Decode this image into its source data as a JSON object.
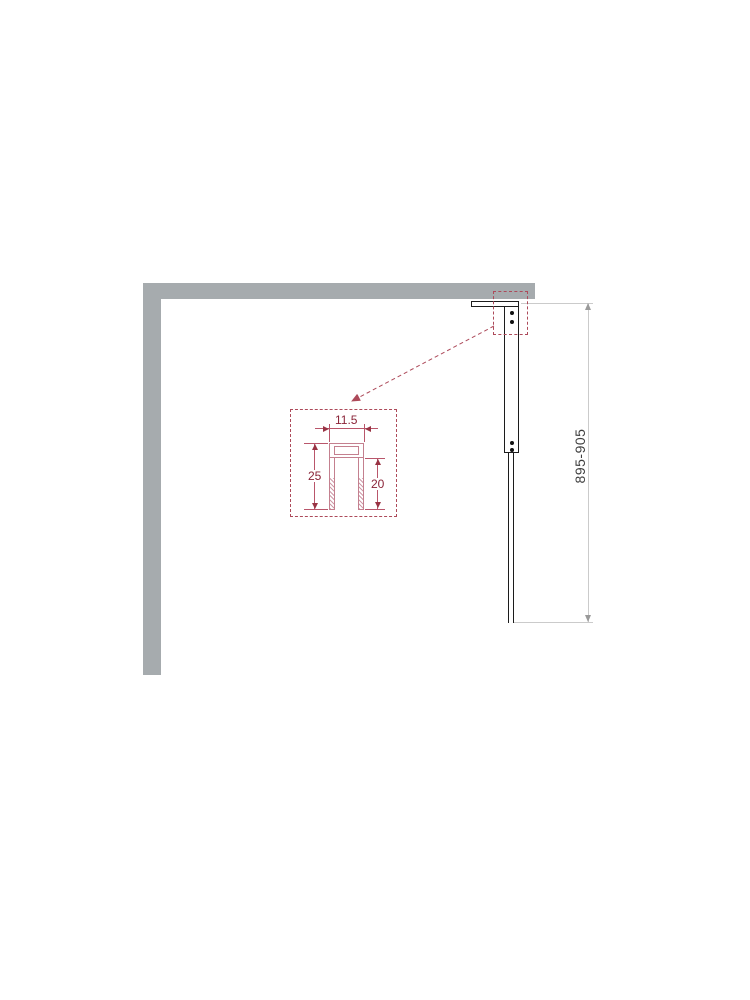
{
  "diagram": {
    "type": "shower-screen-installation-drawing",
    "height_dimension": {
      "label": "895-905"
    },
    "detail_callout": {
      "width": {
        "label": "11.5"
      },
      "depth_outer": {
        "label": "25"
      },
      "depth_inner": {
        "label": "20"
      }
    },
    "colors": {
      "wall_gray": "#a6abae",
      "hardware_outline": "#1c1c1c",
      "dimension_line_gray": "#cbcbcb",
      "dimension_text_gray": "#3f3f3f",
      "callout_red": "#ad4a5a",
      "profile_pink": "#c4808f",
      "dimension_red": "#8a2438"
    }
  }
}
